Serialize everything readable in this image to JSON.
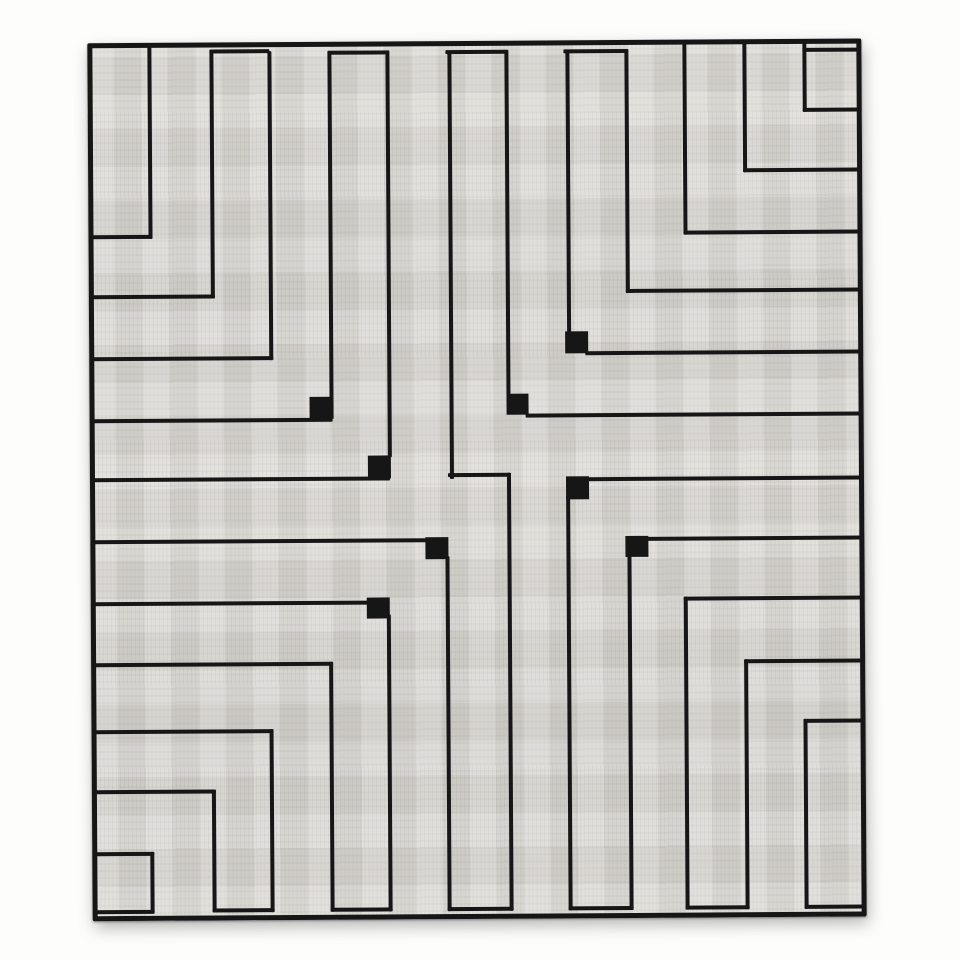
{
  "scene": {
    "description": "Black-and-white photograph of a flat-woven rug (kilim) with a minimalist rectilinear maze pattern of thin black lines on a light gray woven field; small solid black squares mark several inner corner turns.",
    "style": "monochrome photo, hand-woven textile, slight skew and soft drop shadow"
  },
  "palette": {
    "background": "#fdfdfc",
    "field": "#d8d6d1",
    "line": "#161616",
    "shadow": "rgba(0,0,0,0.28)"
  },
  "canvas": {
    "width": 960,
    "height": 960
  },
  "rug": {
    "left": 90,
    "top": 41,
    "width": 774,
    "height": 878,
    "border_thickness": 5,
    "rotation_deg": -0.35
  },
  "maze": {
    "line_thickness": 4,
    "verticals": [
      {
        "x": 150,
        "y1": 44,
        "y2": 237
      },
      {
        "x": 212,
        "y1": 50,
        "y2": 297
      },
      {
        "x": 270,
        "y1": 50,
        "y2": 359
      },
      {
        "x": 330,
        "y1": 52,
        "y2": 398
      },
      {
        "x": 388,
        "y1": 52,
        "y2": 457
      },
      {
        "x": 450,
        "y1": 52,
        "y2": 479
      },
      {
        "x": 507,
        "y1": 52,
        "y2": 397
      },
      {
        "x": 568,
        "y1": 52,
        "y2": 335
      },
      {
        "x": 627,
        "y1": 52,
        "y2": 294
      },
      {
        "x": 685,
        "y1": 44,
        "y2": 236
      },
      {
        "x": 745,
        "y1": 44,
        "y2": 174
      },
      {
        "x": 805,
        "y1": 44,
        "y2": 114
      },
      {
        "x": 507,
        "y1": 473,
        "y2": 911
      },
      {
        "x": 445,
        "y1": 556,
        "y2": 911
      },
      {
        "x": 386,
        "y1": 614,
        "y2": 911
      },
      {
        "x": 328,
        "y1": 661,
        "y2": 911
      },
      {
        "x": 268,
        "y1": 728,
        "y2": 911
      },
      {
        "x": 210,
        "y1": 788,
        "y2": 911
      },
      {
        "x": 148,
        "y1": 850,
        "y2": 911
      },
      {
        "x": 566,
        "y1": 496,
        "y2": 911
      },
      {
        "x": 627,
        "y1": 556,
        "y2": 911
      },
      {
        "x": 683,
        "y1": 598,
        "y2": 911
      },
      {
        "x": 743,
        "y1": 661,
        "y2": 911
      },
      {
        "x": 802,
        "y1": 721,
        "y2": 911
      }
    ],
    "horizontals": [
      {
        "y": 48,
        "x1": 212,
        "x2": 272
      },
      {
        "y": 50,
        "x1": 330,
        "x2": 392
      },
      {
        "y": 50,
        "x1": 448,
        "x2": 511
      },
      {
        "y": 50,
        "x1": 566,
        "x2": 631
      },
      {
        "y": 50,
        "x1": 805,
        "x2": 862
      },
      {
        "y": 233,
        "x1": 92,
        "x2": 154
      },
      {
        "y": 293,
        "x1": 92,
        "x2": 216
      },
      {
        "y": 355,
        "x1": 92,
        "x2": 274
      },
      {
        "y": 417,
        "x1": 92,
        "x2": 333
      },
      {
        "y": 476,
        "x1": 92,
        "x2": 390
      },
      {
        "y": 538,
        "x1": 92,
        "x2": 427
      },
      {
        "y": 600,
        "x1": 92,
        "x2": 369
      },
      {
        "y": 661,
        "x1": 92,
        "x2": 332
      },
      {
        "y": 728,
        "x1": 92,
        "x2": 272
      },
      {
        "y": 788,
        "x1": 92,
        "x2": 214
      },
      {
        "y": 850,
        "x1": 92,
        "x2": 152
      },
      {
        "y": 908,
        "x1": 92,
        "x2": 152
      },
      {
        "y": 110,
        "x1": 805,
        "x2": 862
      },
      {
        "y": 170,
        "x1": 745,
        "x2": 862
      },
      {
        "y": 232,
        "x1": 685,
        "x2": 862
      },
      {
        "y": 290,
        "x1": 627,
        "x2": 862
      },
      {
        "y": 352,
        "x1": 586,
        "x2": 862
      },
      {
        "y": 414,
        "x1": 526,
        "x2": 862
      },
      {
        "y": 478,
        "x1": 586,
        "x2": 862
      },
      {
        "y": 538,
        "x1": 645,
        "x2": 862
      },
      {
        "y": 598,
        "x1": 683,
        "x2": 862
      },
      {
        "y": 661,
        "x1": 743,
        "x2": 862
      },
      {
        "y": 721,
        "x1": 802,
        "x2": 862
      },
      {
        "y": 907,
        "x1": 802,
        "x2": 862
      },
      {
        "y": 473,
        "x1": 448,
        "x2": 511
      },
      {
        "y": 907,
        "x1": 210,
        "x2": 272
      },
      {
        "y": 907,
        "x1": 328,
        "x2": 390
      },
      {
        "y": 907,
        "x1": 445,
        "x2": 511
      },
      {
        "y": 907,
        "x1": 566,
        "x2": 631
      },
      {
        "y": 907,
        "x1": 683,
        "x2": 747
      }
    ],
    "corner_squares": [
      {
        "x": 310,
        "y": 396,
        "w": 24,
        "h": 22
      },
      {
        "x": 368,
        "y": 455,
        "w": 23,
        "h": 23
      },
      {
        "x": 425,
        "y": 537,
        "w": 23,
        "h": 22
      },
      {
        "x": 507,
        "y": 394,
        "w": 22,
        "h": 21
      },
      {
        "x": 566,
        "y": 332,
        "w": 23,
        "h": 22
      },
      {
        "x": 566,
        "y": 477,
        "w": 23,
        "h": 23
      },
      {
        "x": 625,
        "y": 537,
        "w": 23,
        "h": 21
      },
      {
        "x": 366,
        "y": 597,
        "w": 23,
        "h": 21
      }
    ]
  }
}
